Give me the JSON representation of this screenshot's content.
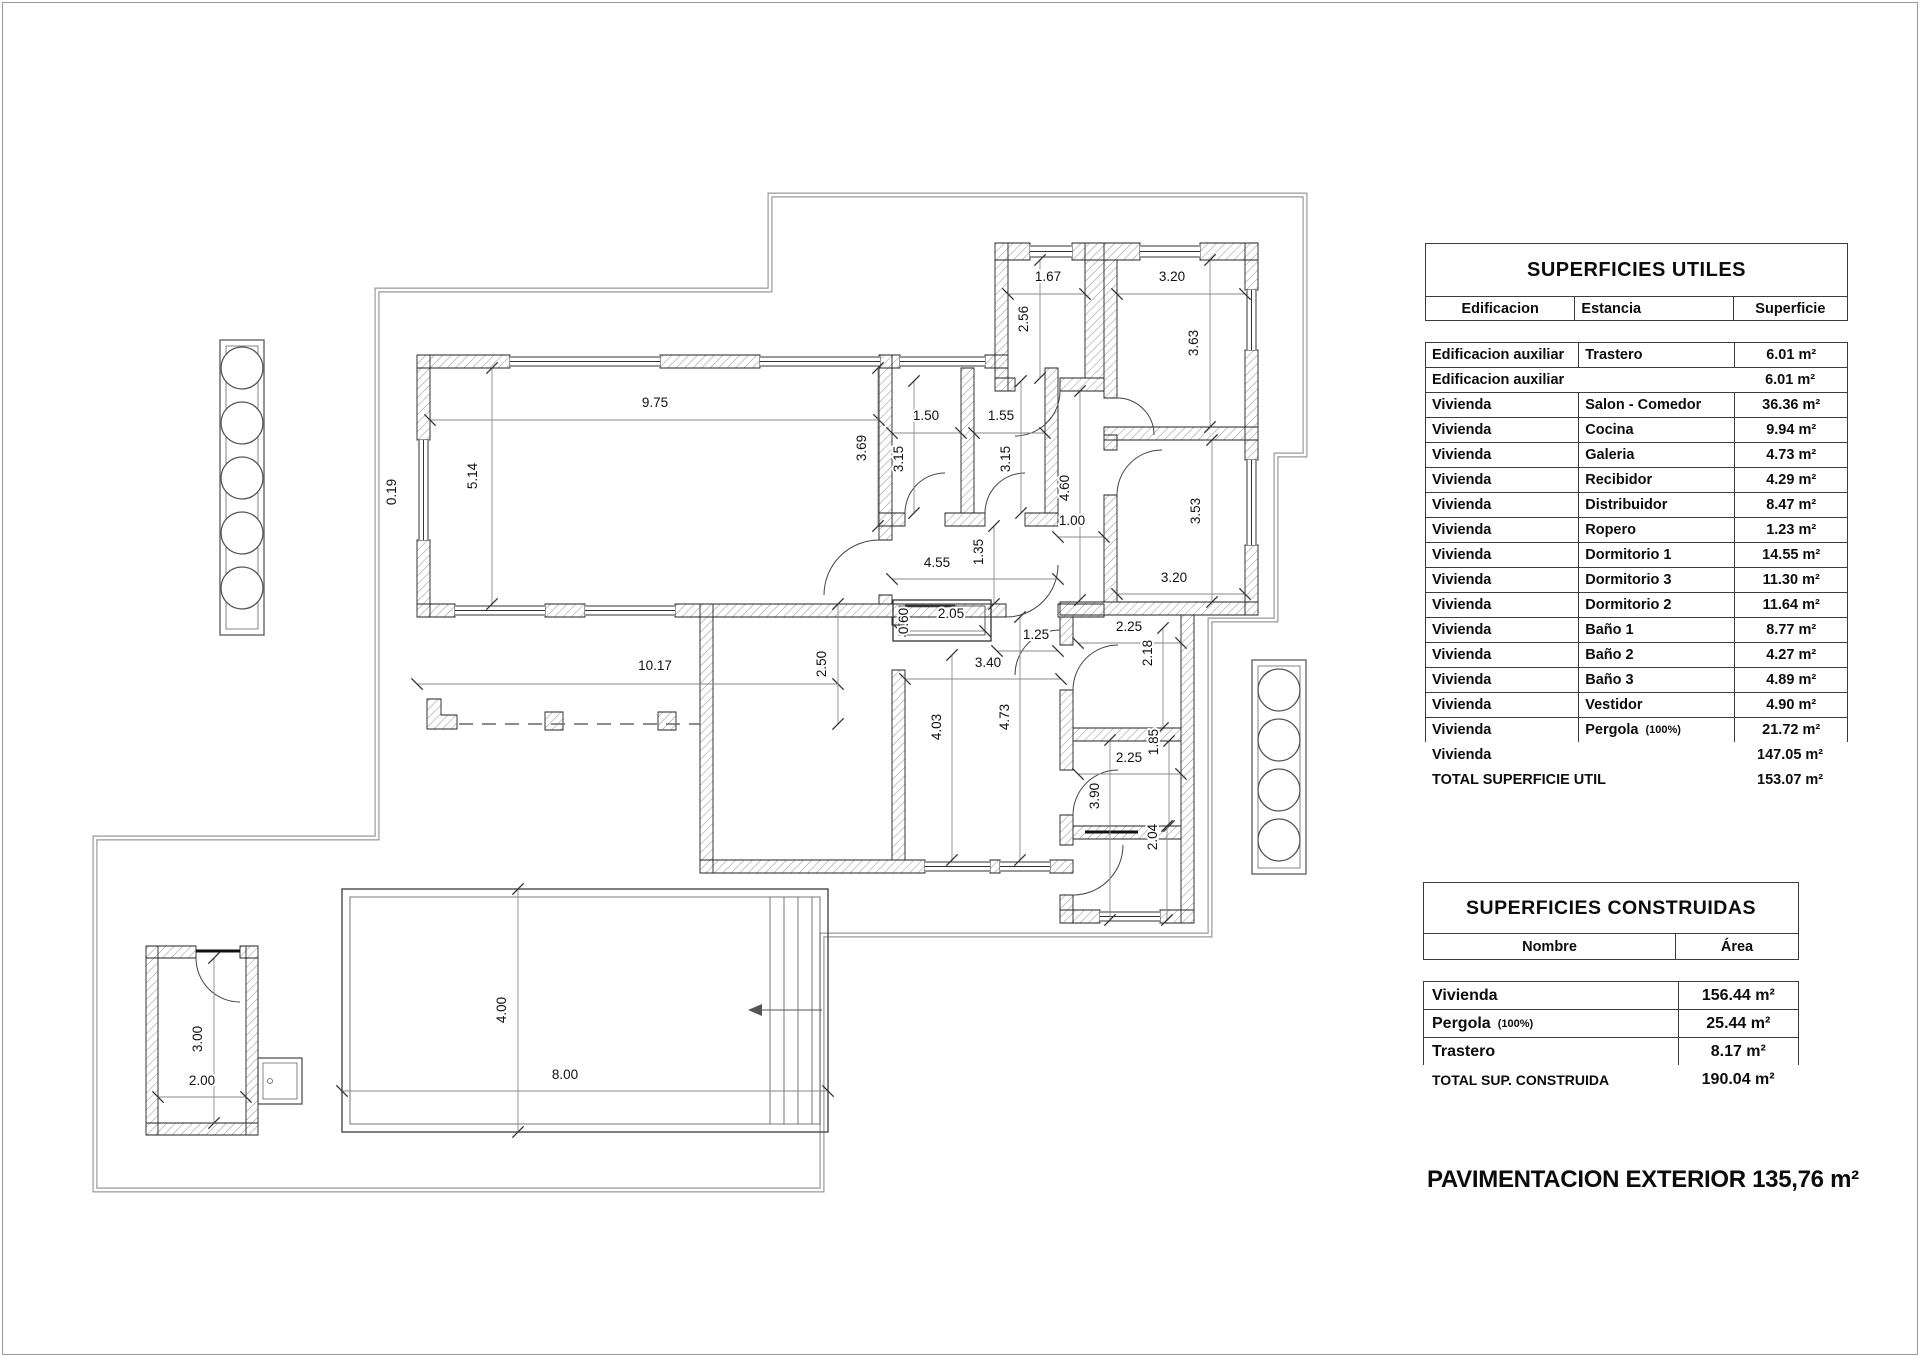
{
  "page": {
    "caption": "PAVIMENTACION EXTERIOR 135,76 m²"
  },
  "tables": {
    "utiles": {
      "title": "SUPERFICIES UTILES",
      "headers": [
        "Edificacion",
        "Estancia",
        "Superficie"
      ],
      "rows": [
        [
          "Edificacion auxiliar",
          "Trastero",
          "6.01 m²"
        ],
        [
          "Edificacion auxiliar",
          "",
          "6.01 m²"
        ],
        [
          "Vivienda",
          "Salon - Comedor",
          "36.36 m²"
        ],
        [
          "Vivienda",
          "Cocina",
          "9.94 m²"
        ],
        [
          "Vivienda",
          "Galeria",
          "4.73 m²"
        ],
        [
          "Vivienda",
          "Recibidor",
          "4.29 m²"
        ],
        [
          "Vivienda",
          "Distribuidor",
          "8.47 m²"
        ],
        [
          "Vivienda",
          "Ropero",
          "1.23 m²"
        ],
        [
          "Vivienda",
          "Dormitorio 1",
          "14.55 m²"
        ],
        [
          "Vivienda",
          "Dormitorio 3",
          "11.30 m²"
        ],
        [
          "Vivienda",
          "Dormitorio 2",
          "11.64 m²"
        ],
        [
          "Vivienda",
          "Baño 1",
          "8.77 m²"
        ],
        [
          "Vivienda",
          "Baño 2",
          "4.27 m²"
        ],
        [
          "Vivienda",
          "Baño 3",
          "4.89 m²"
        ],
        [
          "Vivienda",
          "Vestidor",
          "4.90 m²"
        ],
        [
          "Vivienda",
          "Pergola (100%)",
          "21.72 m²"
        ]
      ],
      "totals": [
        [
          "Vivienda",
          "147.05 m²"
        ],
        [
          "TOTAL SUPERFICIE UTIL",
          "153.07 m²"
        ]
      ]
    },
    "construidas": {
      "title": "SUPERFICIES CONSTRUIDAS",
      "headers": [
        "Nombre",
        "Área"
      ],
      "rows": [
        [
          "Vivienda",
          "156.44 m²"
        ],
        [
          "Pergola (100%)",
          "25.44 m²"
        ],
        [
          "Trastero",
          "8.17 m²"
        ]
      ],
      "totals": [
        [
          "TOTAL SUP. CONSTRUIDA",
          "190.04 m²"
        ]
      ]
    }
  },
  "plan": {
    "dim_labels": [
      {
        "v": "9.75",
        "x": 655,
        "y": 407
      },
      {
        "v": "5.14",
        "x": 477,
        "y": 476,
        "r": 1
      },
      {
        "v": "0.19",
        "x": 396,
        "y": 492,
        "r": 1
      },
      {
        "v": "3.69",
        "x": 866,
        "y": 448,
        "r": 1
      },
      {
        "v": "1.50",
        "x": 926,
        "y": 420
      },
      {
        "v": "1.55",
        "x": 1001,
        "y": 420
      },
      {
        "v": "3.15",
        "x": 903,
        "y": 459,
        "r": 1
      },
      {
        "v": "3.15",
        "x": 1010,
        "y": 459,
        "r": 1
      },
      {
        "v": "4.60",
        "x": 1069,
        "y": 488,
        "r": 1
      },
      {
        "v": "1.00",
        "x": 1072,
        "y": 525
      },
      {
        "v": "1.67",
        "x": 1048,
        "y": 281
      },
      {
        "v": "2.56",
        "x": 1028,
        "y": 319,
        "r": 1
      },
      {
        "v": "3.20",
        "x": 1172,
        "y": 281
      },
      {
        "v": "3.63",
        "x": 1198,
        "y": 343,
        "r": 1
      },
      {
        "v": "3.53",
        "x": 1200,
        "y": 511,
        "r": 1
      },
      {
        "v": "3.20",
        "x": 1174,
        "y": 582
      },
      {
        "v": "4.55",
        "x": 937,
        "y": 567
      },
      {
        "v": "1.35",
        "x": 983,
        "y": 552,
        "r": 1
      },
      {
        "v": "2.05",
        "x": 951,
        "y": 618
      },
      {
        "v": "0.60",
        "x": 908,
        "y": 621,
        "r": 1
      },
      {
        "v": "1.25",
        "x": 1036,
        "y": 639
      },
      {
        "v": "2.25",
        "x": 1129,
        "y": 631
      },
      {
        "v": "2.18",
        "x": 1152,
        "y": 653,
        "r": 1
      },
      {
        "v": "3.40",
        "x": 988,
        "y": 667
      },
      {
        "v": "4.73",
        "x": 1009,
        "y": 717,
        "r": 1
      },
      {
        "v": "4.03",
        "x": 941,
        "y": 727,
        "r": 1
      },
      {
        "v": "2.25",
        "x": 1129,
        "y": 762
      },
      {
        "v": "1.85",
        "x": 1158,
        "y": 742,
        "r": 1
      },
      {
        "v": "3.90",
        "x": 1099,
        "y": 796,
        "r": 1
      },
      {
        "v": "2.04",
        "x": 1157,
        "y": 837,
        "r": 1
      },
      {
        "v": "10.17",
        "x": 655,
        "y": 670
      },
      {
        "v": "2.50",
        "x": 826,
        "y": 664,
        "r": 1
      },
      {
        "v": "4.00",
        "x": 506,
        "y": 1010,
        "r": 1
      },
      {
        "v": "8.00",
        "x": 565,
        "y": 1079
      },
      {
        "v": "3.00",
        "x": 202,
        "y": 1039,
        "r": 1
      },
      {
        "v": "2.00",
        "x": 202,
        "y": 1085
      }
    ],
    "dim_lines": [
      [
        430,
        420,
        879,
        420
      ],
      [
        492,
        368,
        492,
        604
      ],
      [
        878,
        368,
        878,
        526
      ],
      [
        892,
        433,
        961,
        433
      ],
      [
        974,
        433,
        1045,
        433
      ],
      [
        914,
        381,
        914,
        513
      ],
      [
        1021,
        381,
        1021,
        513
      ],
      [
        1080,
        391,
        1080,
        600
      ],
      [
        1058,
        537,
        1104,
        537
      ],
      [
        1008,
        294,
        1085,
        294
      ],
      [
        1040,
        260,
        1040,
        378
      ],
      [
        1117,
        294,
        1245,
        294
      ],
      [
        1210,
        260,
        1210,
        427
      ],
      [
        1212,
        440,
        1212,
        602
      ],
      [
        1117,
        594,
        1245,
        594
      ],
      [
        892,
        579,
        1058,
        579
      ],
      [
        994,
        526,
        994,
        604
      ],
      [
        900,
        631,
        985,
        631
      ],
      [
        997,
        651,
        1058,
        651
      ],
      [
        1078,
        643,
        1181,
        643
      ],
      [
        1163,
        628,
        1163,
        728
      ],
      [
        905,
        679,
        1061,
        679
      ],
      [
        1020,
        617,
        1020,
        860
      ],
      [
        952,
        655,
        952,
        860
      ],
      [
        1078,
        774,
        1181,
        774
      ],
      [
        1169,
        741,
        1169,
        826
      ],
      [
        1110,
        740,
        1110,
        920
      ],
      [
        1167,
        826,
        1167,
        920
      ],
      [
        417,
        684,
        838,
        684
      ],
      [
        838,
        604,
        838,
        724
      ],
      [
        518,
        889,
        518,
        1132
      ],
      [
        342,
        1091,
        828,
        1091
      ],
      [
        214,
        958,
        214,
        1123
      ],
      [
        158,
        1097,
        246,
        1097
      ]
    ]
  }
}
